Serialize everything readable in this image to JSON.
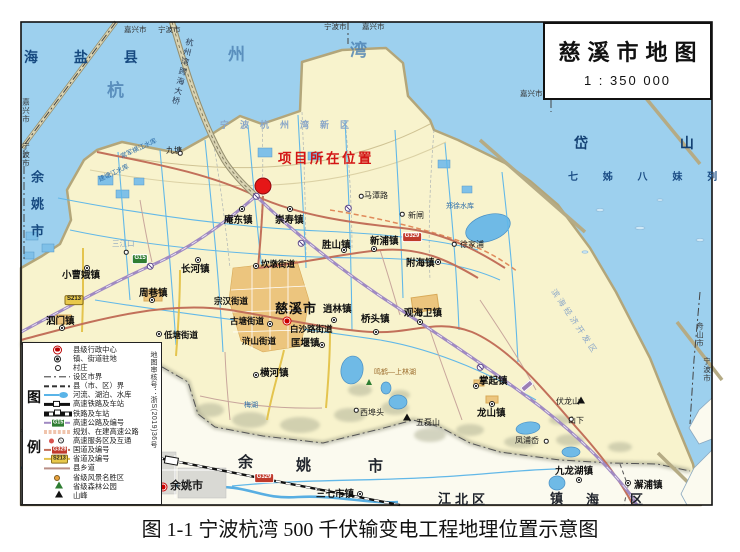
{
  "title_box": {
    "title": "慈溪市地图",
    "scale": "1 : 350 000"
  },
  "caption": "图 1-1 宁波杭湾 500 千伏输变电工程地理位置示意图",
  "legend": {
    "side": [
      "图",
      "例"
    ],
    "review_no": "地图审核号：浙S(2019)36号",
    "items": [
      {
        "kind": "admin",
        "label": "县级行政中心"
      },
      {
        "kind": "townk",
        "label": "镇、街道驻地"
      },
      {
        "kind": "villagek",
        "label": "村庄"
      },
      {
        "kind": "cityline",
        "label": "设区市界"
      },
      {
        "kind": "countyline",
        "label": "县（市、区）界"
      },
      {
        "kind": "riverk",
        "label": "河流、湖泊、水库"
      },
      {
        "kind": "hsrk",
        "label": "高速铁路及车站"
      },
      {
        "kind": "railk",
        "label": "铁路及车站"
      },
      {
        "kind": "expwyk",
        "label": "高速公路及编号",
        "badge": "G15"
      },
      {
        "kind": "plannedk",
        "label": "规划、在建高速公路"
      },
      {
        "kind": "servicek",
        "label": "高速服务区及互通"
      },
      {
        "kind": "nationalk",
        "label": "国道及编号",
        "badge": "G329"
      },
      {
        "kind": "provincialk",
        "label": "省道及编号",
        "badge": "S213"
      },
      {
        "kind": "countyroadk",
        "label": "县乡道"
      },
      {
        "kind": "scenick",
        "label": "省级风景名胜区"
      },
      {
        "kind": "forestk",
        "label": "省级森林公园"
      },
      {
        "kind": "peakk",
        "label": "山峰"
      }
    ]
  },
  "labels": [
    {
      "text": "海 盐 县",
      "x": 24,
      "y": 50,
      "cls": "sea-lg"
    },
    {
      "text": "杭",
      "x": 107,
      "y": 82,
      "cls": "sea-xl"
    },
    {
      "text": "州",
      "x": 228,
      "y": 46,
      "cls": "sea-xl"
    },
    {
      "text": "湾",
      "x": 350,
      "y": 42,
      "cls": "sea-xl"
    },
    {
      "text": "岱 山 县",
      "x": 574,
      "y": 136,
      "cls": "spread-xl"
    },
    {
      "text": "七 姊 八 妹 列 岛",
      "x": 568,
      "y": 173,
      "cls": "sea-sm-spread"
    },
    {
      "text": "余姚市",
      "x": 30,
      "y": 170,
      "cls": "sea-vert"
    },
    {
      "text": "嘉兴市",
      "x": 22,
      "y": 98,
      "cls": "bnd-vert"
    },
    {
      "text": "宁波市",
      "x": 22,
      "y": 142,
      "cls": "bnd-vert"
    },
    {
      "text": "嘉兴市",
      "x": 124,
      "y": 26,
      "cls": "bnd"
    },
    {
      "text": "宁波市",
      "x": 158,
      "y": 26,
      "cls": "bnd"
    },
    {
      "text": "宁波市",
      "x": 324,
      "y": 23,
      "cls": "bnd"
    },
    {
      "text": "嘉兴市",
      "x": 362,
      "y": 23,
      "cls": "bnd"
    },
    {
      "text": "嘉兴市",
      "x": 520,
      "y": 90,
      "cls": "bnd"
    },
    {
      "text": "舟山市",
      "x": 556,
      "y": 90,
      "cls": "bnd"
    },
    {
      "text": "舟山市",
      "x": 696,
      "y": 322,
      "cls": "bnd-vert"
    },
    {
      "text": "宁波市",
      "x": 703,
      "y": 357,
      "cls": "bnd-vert"
    },
    {
      "text": "杭州湾跨海大桥",
      "x": 186,
      "y": 38,
      "cls": "bridge-vert"
    },
    {
      "text": "宁波杭州湾新区",
      "x": 220,
      "y": 121,
      "cls": "district"
    },
    {
      "text": "滨海经济开发区",
      "x": 556,
      "y": 288,
      "cls": "district-rot"
    },
    {
      "text": "项目所在位置",
      "x": 278,
      "y": 152,
      "cls": "project"
    },
    {
      "text": "郑徐水库",
      "x": 446,
      "y": 203,
      "cls": "wname"
    },
    {
      "text": "常军横江水库",
      "x": 120,
      "y": 155,
      "cls": "wname-rot"
    },
    {
      "text": "建塘江水库",
      "x": 98,
      "y": 178,
      "cls": "wname-rot"
    },
    {
      "text": "三江口",
      "x": 112,
      "y": 240,
      "cls": "vil-faint"
    },
    {
      "text": "鸣鹤—上林湖",
      "x": 374,
      "y": 369,
      "cls": "scenic"
    },
    {
      "text": "梅湖",
      "x": 244,
      "y": 402,
      "cls": "wname"
    },
    {
      "text": "九塘",
      "x": 166,
      "y": 147,
      "cls": "vil"
    },
    {
      "text": "庵东镇",
      "x": 224,
      "y": 216,
      "cls": "town"
    },
    {
      "text": "崇寿镇",
      "x": 275,
      "y": 216,
      "cls": "town"
    },
    {
      "text": "马潭路",
      "x": 364,
      "y": 192,
      "cls": "vil"
    },
    {
      "text": "新闸",
      "x": 408,
      "y": 212,
      "cls": "vil"
    },
    {
      "text": "徐家浦",
      "x": 460,
      "y": 241,
      "cls": "vil"
    },
    {
      "text": "新浦镇",
      "x": 370,
      "y": 237,
      "cls": "town"
    },
    {
      "text": "胜山镇",
      "x": 322,
      "y": 241,
      "cls": "town"
    },
    {
      "text": "附海镇",
      "x": 406,
      "y": 259,
      "cls": "town"
    },
    {
      "text": "坎墩街道",
      "x": 261,
      "y": 260,
      "cls": "town-sm"
    },
    {
      "text": "宗汉街道",
      "x": 214,
      "y": 297,
      "cls": "town-sm"
    },
    {
      "text": "古塘街道",
      "x": 230,
      "y": 317,
      "cls": "town-sm"
    },
    {
      "text": "慈溪市",
      "x": 275,
      "y": 302,
      "cls": "city"
    },
    {
      "text": "白沙路街道",
      "x": 290,
      "y": 325,
      "cls": "town-sm"
    },
    {
      "text": "浒山街道",
      "x": 242,
      "y": 337,
      "cls": "town-sm"
    },
    {
      "text": "匡堰镇",
      "x": 291,
      "y": 339,
      "cls": "town"
    },
    {
      "text": "逍林镇",
      "x": 323,
      "y": 305,
      "cls": "town"
    },
    {
      "text": "桥头镇",
      "x": 361,
      "y": 315,
      "cls": "town"
    },
    {
      "text": "观海卫镇",
      "x": 404,
      "y": 309,
      "cls": "town"
    },
    {
      "text": "横河镇",
      "x": 260,
      "y": 369,
      "cls": "town"
    },
    {
      "text": "长河镇",
      "x": 181,
      "y": 265,
      "cls": "town"
    },
    {
      "text": "周巷镇",
      "x": 139,
      "y": 289,
      "cls": "town"
    },
    {
      "text": "小曹娥镇",
      "x": 62,
      "y": 271,
      "cls": "town"
    },
    {
      "text": "泗门镇",
      "x": 46,
      "y": 317,
      "cls": "town"
    },
    {
      "text": "低塘街道",
      "x": 164,
      "y": 331,
      "cls": "town-sm"
    },
    {
      "text": "掌起镇",
      "x": 479,
      "y": 377,
      "cls": "town"
    },
    {
      "text": "龙山镇",
      "x": 477,
      "y": 409,
      "cls": "town"
    },
    {
      "text": "伏龙山",
      "x": 556,
      "y": 398,
      "cls": "vil"
    },
    {
      "text": "山下",
      "x": 568,
      "y": 417,
      "cls": "vil"
    },
    {
      "text": "凤浦岙",
      "x": 515,
      "y": 437,
      "cls": "vil"
    },
    {
      "text": "西埠头",
      "x": 360,
      "y": 409,
      "cls": "vil"
    },
    {
      "text": "五磊山",
      "x": 416,
      "y": 419,
      "cls": "vil"
    },
    {
      "text": "三七市镇",
      "x": 316,
      "y": 490,
      "cls": "town"
    },
    {
      "text": "九龙湖镇",
      "x": 555,
      "y": 467,
      "cls": "town"
    },
    {
      "text": "澥浦镇",
      "x": 634,
      "y": 481,
      "cls": "town"
    },
    {
      "text": "余姚市",
      "x": 170,
      "y": 481,
      "cls": "city-red"
    },
    {
      "text": "余",
      "x": 238,
      "y": 455,
      "cls": "region-spread"
    },
    {
      "text": "姚",
      "x": 296,
      "y": 458,
      "cls": "region-spread"
    },
    {
      "text": "市",
      "x": 368,
      "y": 459,
      "cls": "region-spread"
    },
    {
      "text": "江",
      "x": 438,
      "y": 492,
      "cls": "region-spread2"
    },
    {
      "text": "北",
      "x": 455,
      "y": 493,
      "cls": "region-spread2"
    },
    {
      "text": "区",
      "x": 472,
      "y": 493,
      "cls": "region-spread2"
    },
    {
      "text": "镇",
      "x": 550,
      "y": 492,
      "cls": "region-spread2"
    },
    {
      "text": "海",
      "x": 586,
      "y": 493,
      "cls": "region-spread2"
    },
    {
      "text": "区",
      "x": 630,
      "y": 493,
      "cls": "region-spread2"
    }
  ],
  "markers": [
    {
      "kind": "project-dot",
      "x": 263,
      "y": 186
    },
    {
      "kind": "city",
      "x": 287,
      "y": 321
    },
    {
      "kind": "city",
      "x": 163,
      "y": 487
    },
    {
      "kind": "town",
      "x": 242,
      "y": 209
    },
    {
      "kind": "town",
      "x": 290,
      "y": 209
    },
    {
      "kind": "town",
      "x": 256,
      "y": 266
    },
    {
      "kind": "town",
      "x": 270,
      "y": 324
    },
    {
      "kind": "town",
      "x": 322,
      "y": 345
    },
    {
      "kind": "town",
      "x": 334,
      "y": 320
    },
    {
      "kind": "town",
      "x": 376,
      "y": 332
    },
    {
      "kind": "town",
      "x": 420,
      "y": 322
    },
    {
      "kind": "town",
      "x": 256,
      "y": 375
    },
    {
      "kind": "town",
      "x": 476,
      "y": 386
    },
    {
      "kind": "town",
      "x": 492,
      "y": 404
    },
    {
      "kind": "town",
      "x": 198,
      "y": 260
    },
    {
      "kind": "town",
      "x": 152,
      "y": 300
    },
    {
      "kind": "town",
      "x": 87,
      "y": 268
    },
    {
      "kind": "town",
      "x": 62,
      "y": 328
    },
    {
      "kind": "town",
      "x": 159,
      "y": 334
    },
    {
      "kind": "town",
      "x": 374,
      "y": 249
    },
    {
      "kind": "town",
      "x": 344,
      "y": 250
    },
    {
      "kind": "town",
      "x": 438,
      "y": 262
    },
    {
      "kind": "town",
      "x": 360,
      "y": 494
    },
    {
      "kind": "town",
      "x": 579,
      "y": 480
    },
    {
      "kind": "town",
      "x": 628,
      "y": 483
    },
    {
      "kind": "village",
      "x": 361,
      "y": 196
    },
    {
      "kind": "village",
      "x": 402,
      "y": 214
    },
    {
      "kind": "village",
      "x": 454,
      "y": 244
    },
    {
      "kind": "village",
      "x": 546,
      "y": 441
    },
    {
      "kind": "village",
      "x": 571,
      "y": 419
    },
    {
      "kind": "village",
      "x": 356,
      "y": 410
    },
    {
      "kind": "village",
      "x": 180,
      "y": 153
    },
    {
      "kind": "village",
      "x": 126,
      "y": 252
    },
    {
      "kind": "peak",
      "x": 407,
      "y": 417
    },
    {
      "kind": "peak",
      "x": 581,
      "y": 400
    },
    {
      "kind": "tree",
      "x": 369,
      "y": 382
    },
    {
      "kind": "interchange",
      "x": 256,
      "y": 196
    },
    {
      "kind": "interchange",
      "x": 301,
      "y": 243
    },
    {
      "kind": "interchange",
      "x": 150,
      "y": 266
    },
    {
      "kind": "interchange",
      "x": 480,
      "y": 367
    },
    {
      "kind": "interchange",
      "x": 348,
      "y": 208
    },
    {
      "kind": "svc",
      "x": 527,
      "y": 386
    }
  ],
  "badges": [
    {
      "text": "G15",
      "x": 140,
      "y": 259,
      "kind": "g"
    },
    {
      "text": "G329",
      "x": 412,
      "y": 237,
      "kind": "gn"
    },
    {
      "text": "G329",
      "x": 264,
      "y": 478,
      "kind": "gn"
    },
    {
      "text": "S213",
      "x": 74,
      "y": 300,
      "kind": "s"
    }
  ]
}
